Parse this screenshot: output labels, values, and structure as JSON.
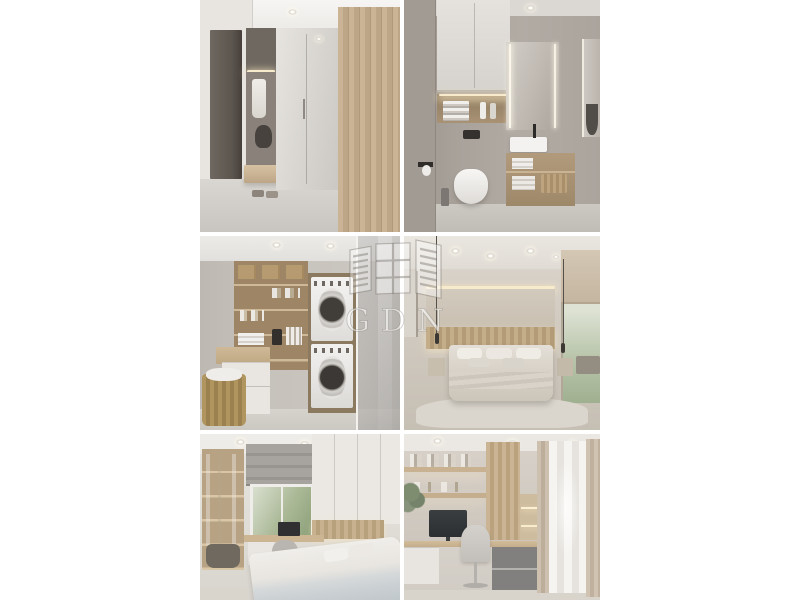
{
  "page": {
    "background_color": "#ffffff",
    "kind": "real-estate interior photo collage"
  },
  "watermark": {
    "text": "GDN",
    "logo_icon": "open-window-with-shutters-icon",
    "text_color": "#ffffff",
    "outline_color": "#6e6962",
    "opacity": 0.55
  },
  "collage": {
    "columns": 2,
    "rows": 3,
    "gap_color": "#ffffff",
    "photos": [
      {
        "id": "hallway",
        "title": "Entry hallway with dark door, coat niche with hanging robe and bag, floating wood bench with shoes, mirrored wardrobe and wood-slat closet wall"
      },
      {
        "id": "bathroom",
        "title": "Bathroom with white wall cabinet, lit towel niche, black flush plate, wall-hung toilet, LED mirror and wood vanity with countertop basin"
      },
      {
        "id": "laundry",
        "title": "Laundry room with open wood shelving, baskets and bottles, stacked washer and dryer, cabinet counter, wicker basket and glass partition"
      },
      {
        "id": "bedroom",
        "title": "Bedroom with cove lighting, wood-slat headboard wall, upholstered bed with pillows, pendant lamps, nightstands, window with roman blind and rug"
      },
      {
        "id": "kids-bedroom",
        "title": "Small bedroom with open shelf unit, roman blind over window, desk with monitor and chair, wardrobe above bed with white and gray bedding"
      },
      {
        "id": "home-office",
        "title": "Home office with lit wood shelves and books, monitor on desk, gray drawers, office chair, wood-slat column, sheer and beige curtains"
      }
    ],
    "palette": {
      "wall_gray": "#c9c3bb",
      "wall_warm": "#d8d2ca",
      "wood_light": "#c2ab8a",
      "wood_mid": "#b29a76",
      "dark_door": "#5c564f",
      "floor": "#cfcbc5",
      "led_warm": "#f6e7c4",
      "appliance_white": "#f0efed",
      "glass_tint": "#b9b6b2",
      "greenery": "#8ba078"
    }
  }
}
